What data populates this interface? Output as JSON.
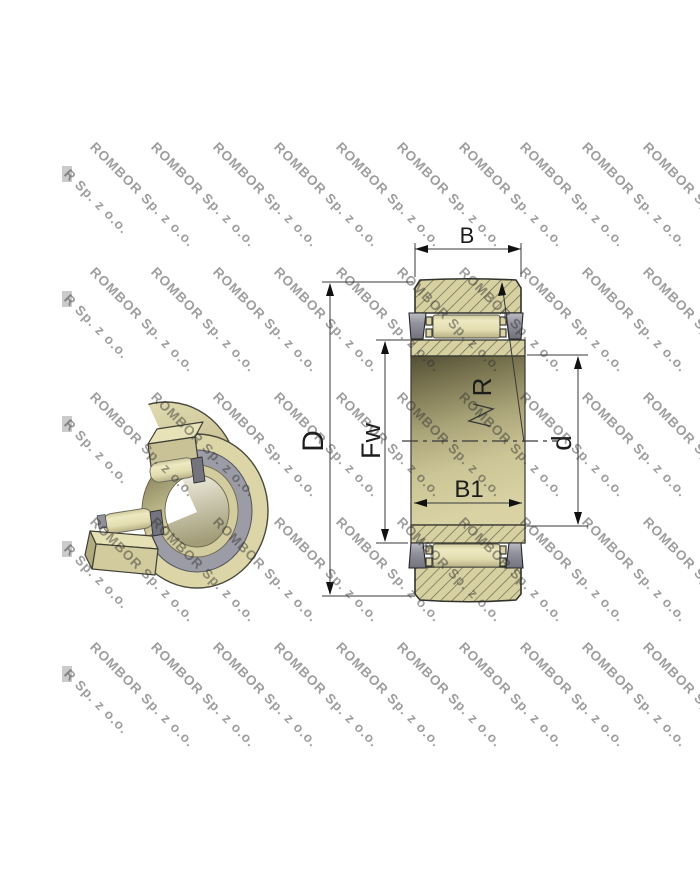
{
  "page": {
    "width": 700,
    "height": 869,
    "background": "#ffffff"
  },
  "watermark": {
    "text": "ROMBOR Sp. z o.o.",
    "color": "rgba(48,48,48,0.47)",
    "angle_deg": 45,
    "rows_y": [
      140,
      265,
      390,
      515,
      640
    ],
    "cols_x": [
      97,
      158,
      220,
      281,
      343,
      404,
      466,
      527,
      589,
      650
    ],
    "partial": {
      "text": "R Sp. z o.o.",
      "text_x": 71,
      "text_dy": 27,
      "blob_x": 62,
      "blob_dy": 26
    }
  },
  "drawing": {
    "subject": "yoke type track roller bearing",
    "views": {
      "iso": "isometric cutaway view",
      "section": "cross-section view"
    },
    "dimension_labels": {
      "B": "B",
      "B1": "B1",
      "D": "D",
      "Fw": "Fw",
      "d": "d",
      "R": "R"
    },
    "colors": {
      "body_beige": "#d7d1a2",
      "body_dark": "#6b6747",
      "hatch_line": "#6a6a52",
      "steel_grey": "#9c9ca6",
      "outline": "#32322c",
      "dim_line": "#3a3a3a",
      "watermark_grey": "#9f9f9f"
    }
  }
}
